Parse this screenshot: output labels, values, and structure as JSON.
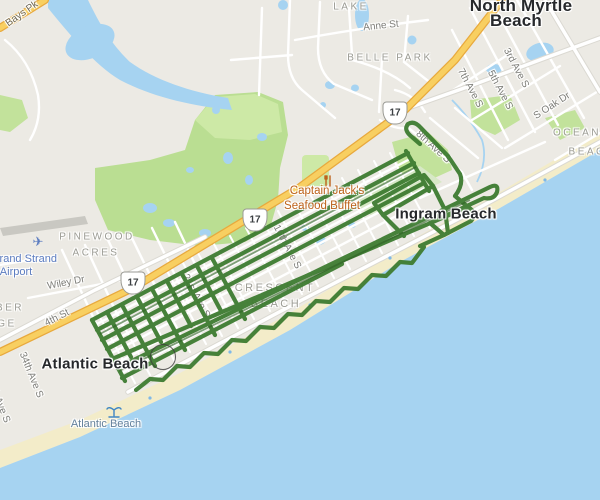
{
  "map": {
    "type": "road-map with GPS activity track",
    "colors": {
      "land": "#eceae4",
      "water": "#a6d3f1",
      "sand": "#f3ecc9",
      "park": "#bade92",
      "park_light": "#cde9a6",
      "highway_fill": "#f8cf61",
      "highway_casing": "#e8a93d",
      "road": "#ffffff",
      "track": "#3e7c31"
    },
    "labels": {
      "cities": [
        {
          "lines": [
            "North Myrtle",
            "Beach"
          ]
        },
        {
          "lines": [
            "Atlantic Beach"
          ]
        },
        {
          "lines": [
            "Ingram Beach"
          ]
        }
      ],
      "areas": [
        {
          "lines": [
            "LAKE"
          ]
        },
        {
          "lines": [
            "BELLE PARK"
          ]
        },
        {
          "lines": [
            "PINEWOOD",
            "ACRES"
          ]
        },
        {
          "lines": [
            "CRESCENT",
            "BEACH"
          ]
        },
        {
          "lines": [
            "OCEAN",
            "BEACH"
          ]
        },
        {
          "lines": [
            "BER",
            "GE"
          ]
        }
      ],
      "streets": [
        "Bays Pk",
        "Anne St",
        "3rd Ave S",
        "5th Ave S",
        "7th Ave S",
        "S Oak Dr",
        "8th Ave S",
        "16th Ave S",
        "21st Ave S",
        "Wiley Dr",
        "4th St",
        "34th Ave S",
        "36th Ave S"
      ],
      "beach_label": "Atlantic Beach",
      "airport": {
        "lines": [
          "Grand Strand",
          "Airport"
        ]
      },
      "poi": {
        "lines": [
          "Captain Jack's",
          "Seafood Buffet"
        ]
      },
      "highway_shields": [
        {
          "route": "17"
        },
        {
          "route": "17"
        },
        {
          "route": "17"
        }
      ]
    },
    "icons": [
      "restaurant-icon",
      "palm-beach-icon",
      "airplane-icon",
      "track-marker-circle"
    ]
  }
}
